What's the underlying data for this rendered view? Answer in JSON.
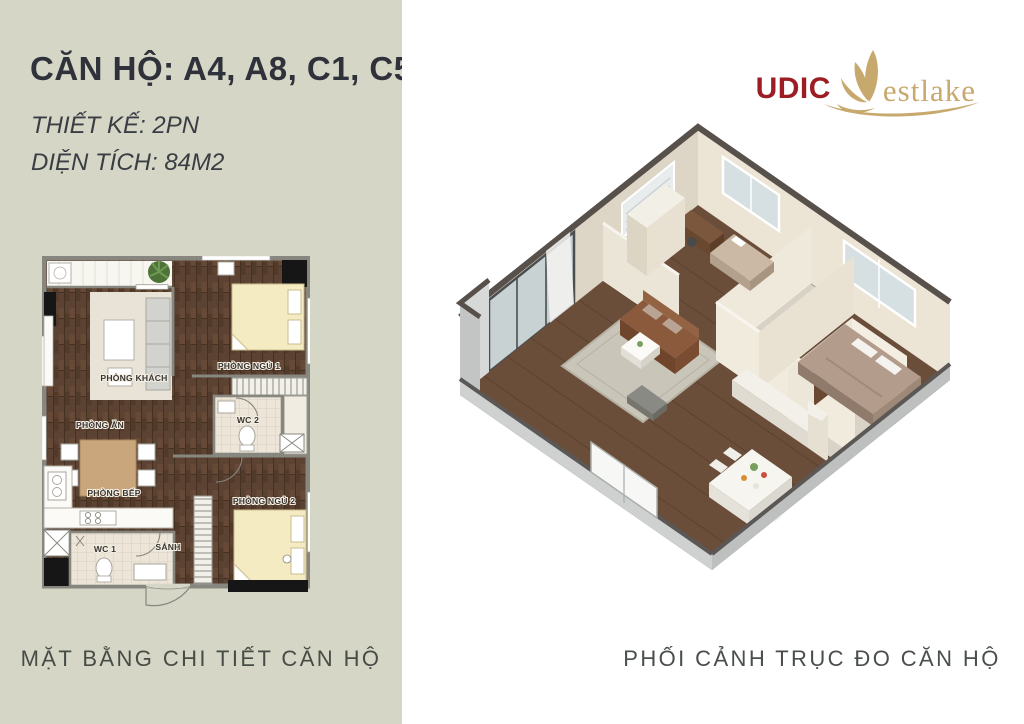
{
  "header": {
    "title": "CĂN HỘ: A4, A8, C1, C5",
    "design_line": "THIẾT KẾ: 2PN",
    "area_line": "DIỆN TÍCH: 84M2"
  },
  "logo": {
    "brand": "UDIC",
    "suffix": "estlake",
    "mark": "lotus-w-icon",
    "brand_color": "#9c1d24",
    "gold_color": "#c7a96e"
  },
  "floor_plan": {
    "caption": "MẶT BẰNG CHI TIẾT CĂN HỘ",
    "rooms": [
      {
        "id": "living",
        "label": "PHÒNG KHÁCH"
      },
      {
        "id": "bedroom1",
        "label": "PHÒNG NGỦ 1"
      },
      {
        "id": "dining",
        "label": "PHÒNG ĂN"
      },
      {
        "id": "wc2",
        "label": "WC 2"
      },
      {
        "id": "kitchen",
        "label": "PHÒNG BẾP"
      },
      {
        "id": "bedroom2",
        "label": "PHÒNG NGỦ 2"
      },
      {
        "id": "wc1",
        "label": "WC 1"
      },
      {
        "id": "hall",
        "label": "SẢNH"
      }
    ]
  },
  "axon_view": {
    "caption": "PHỐI CẢNH TRỤC ĐO CĂN HỘ"
  },
  "palette": {
    "panel_bg": "#d5d6c6",
    "paper_bg": "#ffffff",
    "title_text": "#2f323a",
    "caption_text": "#474c45",
    "wood_floor": "#5c4232",
    "bed_cream": "#f4ebc2",
    "wall_gray": "#87877f"
  }
}
